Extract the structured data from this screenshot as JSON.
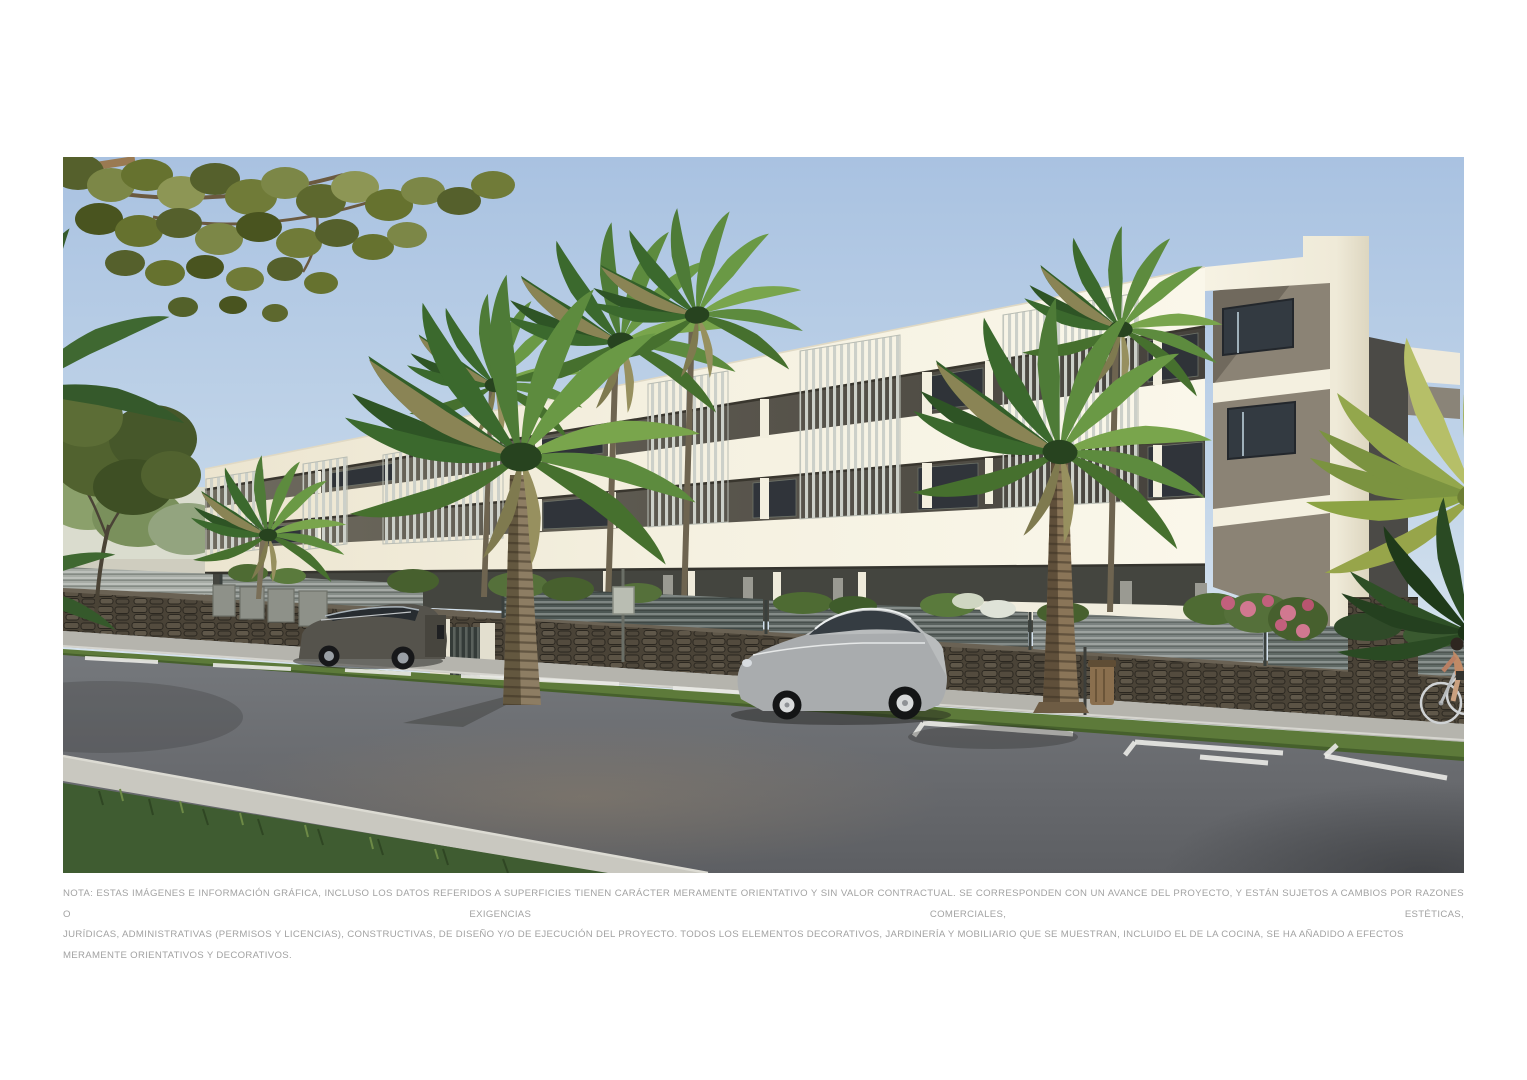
{
  "page": {
    "background": "#ffffff"
  },
  "hero_image": {
    "type": "architectural-render",
    "description": "Exterior render of a modern three-storey cream apartment building with vertical slatted balcony screens, a dark stone boundary wall topped by grey louvre fencing, palm trees, two parked cars, a street with white road markings and a cyclist at the right edge.",
    "palette": {
      "sky_top": "#a9c2e1",
      "sky_horizon": "#e9eef0",
      "facade_cream": "#f5f1e1",
      "recess_dark": "#57534a",
      "louvre_grey": "#ccd0c9",
      "stone_wall": "#4e463a",
      "fence_grey": "#7b8280",
      "road_grey": "#6d7074",
      "grass_green": "#3f5c31",
      "palm_green": "#4e7b37",
      "car_silver": "#b9bcbd",
      "car_dark_grey": "#55534c"
    }
  },
  "disclaimer": {
    "line1": "NOTA: ESTAS IMÁGENES E INFORMACIÓN GRÁFICA, INCLUSO LOS DATOS REFERIDOS A SUPERFICIES TIENEN CARÁCTER MERAMENTE ORIENTATIVO Y SIN VALOR CONTRACTUAL. SE CORRESPONDEN CON UN AVANCE DEL PROYECTO, Y ESTÁN SUJETOS A CAMBIOS POR RAZONES O EXIGENCIAS COMERCIALES, ESTÉTICAS,",
    "line2": "JURÍDICAS, ADMINISTRATIVAS (PERMISOS Y LICENCIAS), CONSTRUCTIVAS, DE DISEÑO Y/O DE EJECUCIÓN DEL PROYECTO. TODOS LOS ELEMENTOS DECORATIVOS, JARDINERÍA Y MOBILIARIO QUE SE MUESTRAN, INCLUIDO EL DE LA COCINA, SE HA AÑADIDO A EFECTOS MERAMENTE ORIENTATIVOS Y DECORATIVOS."
  }
}
